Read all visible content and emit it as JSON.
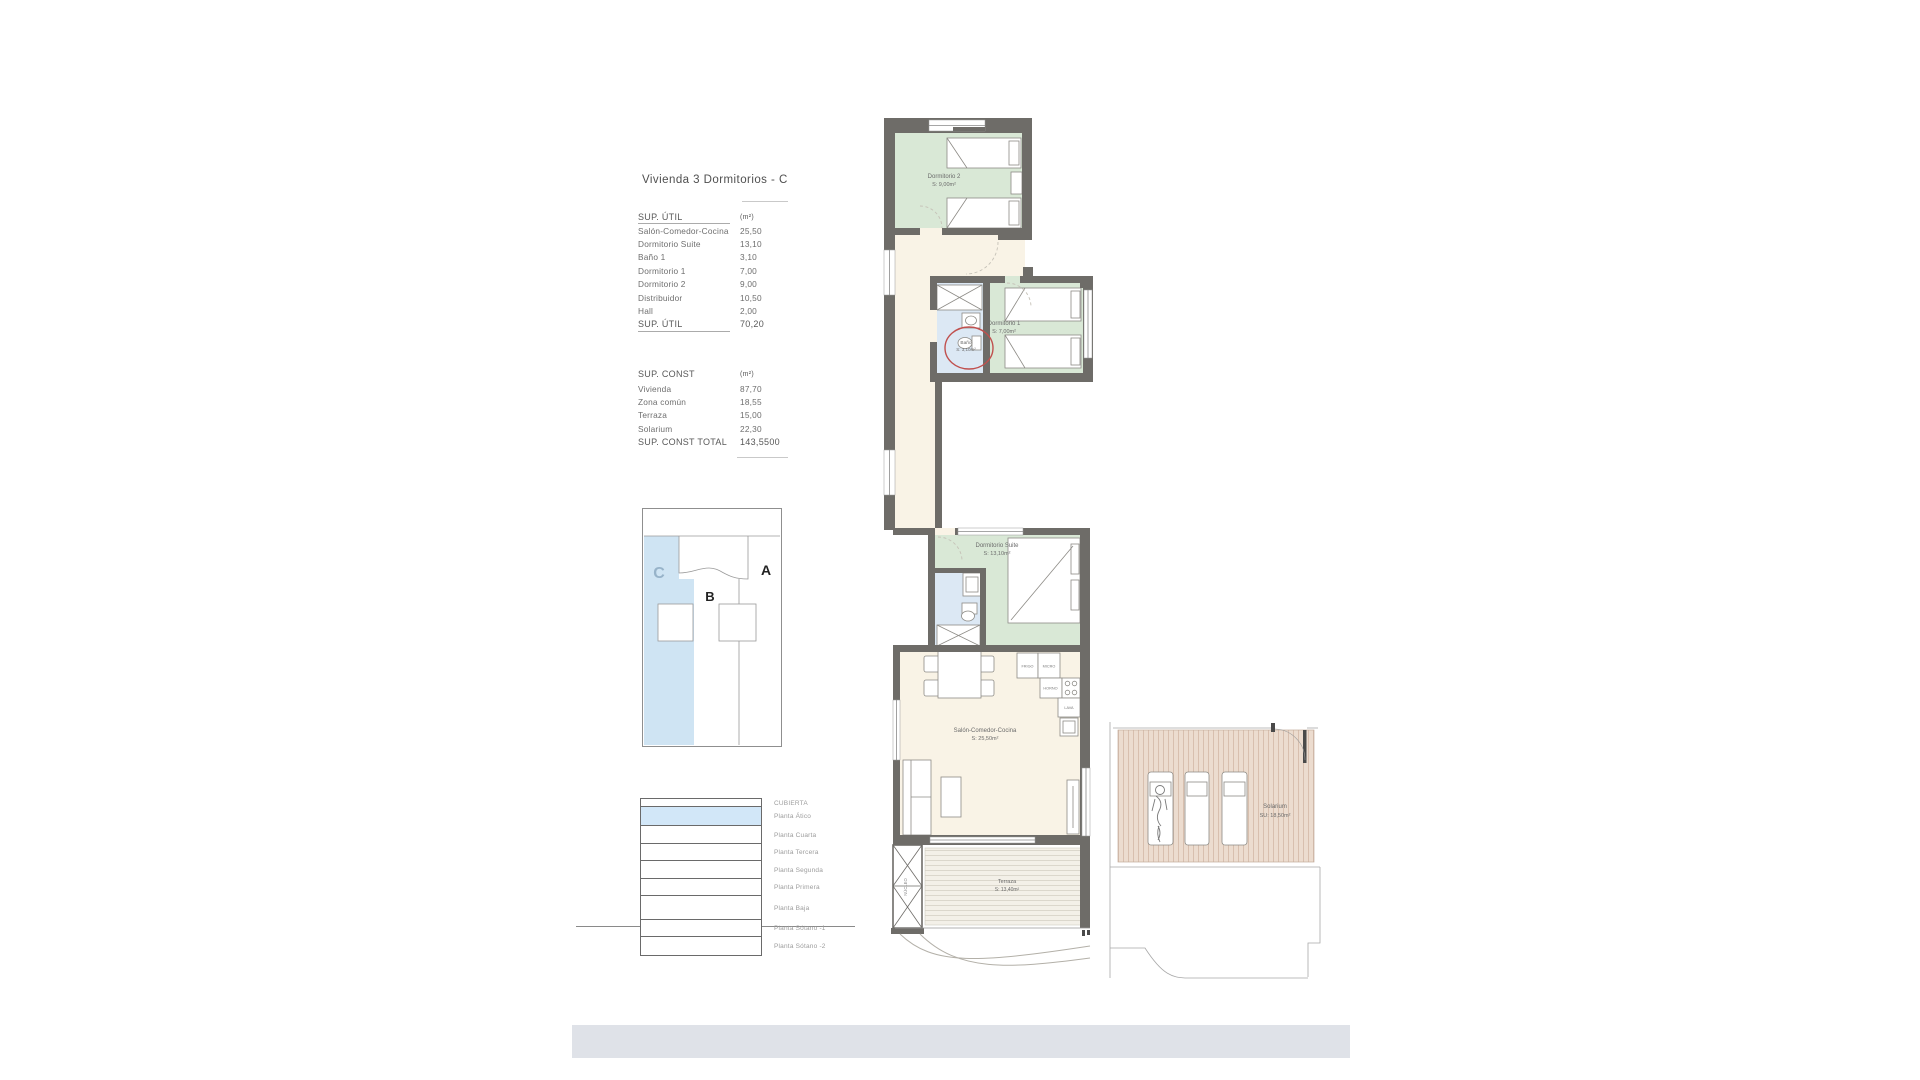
{
  "title": "Vivienda 3 Dormitorios - C",
  "sup_util": {
    "header": {
      "label": "SUP. ÚTIL",
      "unit": "(m²)"
    },
    "rows": [
      {
        "label": "Salón-Comedor-Cocina",
        "value": "25,50"
      },
      {
        "label": "Dormitorio Suite",
        "value": "13,10"
      },
      {
        "label": "Baño 1",
        "value": "3,10"
      },
      {
        "label": "Dormitorio 1",
        "value": "7,00"
      },
      {
        "label": "Dormitorio 2",
        "value": "9,00"
      },
      {
        "label": "Distribuidor",
        "value": "10,50"
      },
      {
        "label": "Hall",
        "value": "2,00"
      }
    ],
    "total": {
      "label": "SUP. ÚTIL",
      "value": "70,20"
    }
  },
  "sup_const": {
    "header": {
      "label": "SUP. CONST",
      "unit": "(m²)"
    },
    "rows": [
      {
        "label": "Vivienda",
        "value": "87,70"
      },
      {
        "label": "Zona común",
        "value": "18,55"
      },
      {
        "label": "Terraza",
        "value": "15,00"
      },
      {
        "label": "Solarium",
        "value": "22,30"
      }
    ],
    "total": {
      "label": "SUP. CONST TOTAL",
      "value": "143,5500"
    }
  },
  "key_plan": {
    "unit_c": "C",
    "unit_b": "B",
    "unit_a": "A"
  },
  "levels": {
    "items": [
      {
        "label": "CUBIERTA"
      },
      {
        "label": "Planta Ático"
      },
      {
        "label": "Planta Cuarta"
      },
      {
        "label": "Planta Tercera"
      },
      {
        "label": "Planta Segunda"
      },
      {
        "label": "Planta Primera"
      },
      {
        "label": "Planta Baja"
      },
      {
        "label": "Planta Sótano -1"
      },
      {
        "label": "Planta Sótano -2"
      }
    ]
  },
  "plan": {
    "rooms": {
      "dormitorio2": {
        "name": "Dormitorio 2",
        "area": "S: 9,00m²"
      },
      "dormitorio1": {
        "name": "Dormitorio 1",
        "area": "S: 7,00m²"
      },
      "bano": {
        "name": "Baño",
        "area": "S: 3,10m²"
      },
      "suite": {
        "name": "Dormitorio Suite",
        "area": "S: 13,10m²"
      },
      "salon": {
        "name": "Salón-Comedor-Cocina",
        "area": "S: 25,50m²"
      },
      "terraza": {
        "name": "Terraza",
        "area": "S: 13,40m²"
      },
      "solarium": {
        "name": "Solarium",
        "area": "SU: 18,50m²"
      }
    },
    "kitchen": {
      "frigo": "FRIGO",
      "micro": "MICRO",
      "horno": "HORNO",
      "lava": "LAVA"
    },
    "core_label": "NÚCLEO"
  },
  "colors": {
    "highlight_blue": "#cfe4f3",
    "level_highlight": "#d2e7f8",
    "wall": "#6e6c68",
    "bedroom_floor": "#d9e8d6",
    "bath_floor": "#dce8f4",
    "living_floor": "#f9f3e6",
    "terrace_deck": "#f3f0e8",
    "solarium_deck": "#ecdccf",
    "annotation_red": "#c0504e",
    "footer_bar": "#dfe2e8"
  }
}
